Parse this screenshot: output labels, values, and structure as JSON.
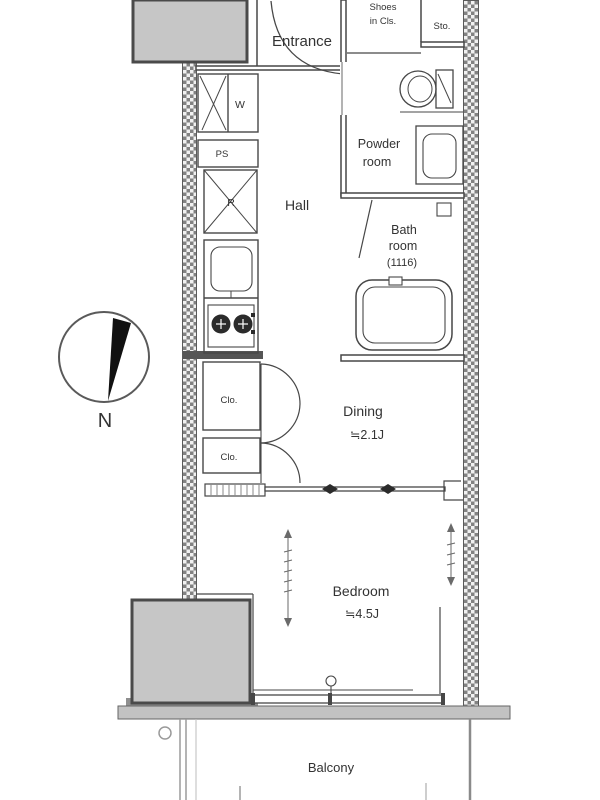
{
  "floor_plan": {
    "rooms": {
      "entrance": {
        "label": "Entrance"
      },
      "hall": {
        "label": "Hall"
      },
      "powder_room": {
        "label_line1": "Powder",
        "label_line2": "room"
      },
      "bath_room": {
        "label_line1": "Bath",
        "label_line2": "room",
        "size": "(1116)"
      },
      "dining": {
        "label": "Dining",
        "size": "≒2.1J"
      },
      "bedroom": {
        "label": "Bedroom",
        "size": "≒4.5J"
      },
      "balcony": {
        "label": "Balcony"
      }
    },
    "storage": {
      "shoes_closet": {
        "label_line1": "Shoes",
        "label_line2": "in Cls."
      },
      "storage_box": {
        "label": "Sto."
      },
      "washer": {
        "label": "W"
      },
      "pipe_space": {
        "label": "PS"
      },
      "refrigerator": {
        "label": "R"
      },
      "closet_upper": {
        "label": "Clo."
      },
      "closet_lower": {
        "label": "Clo."
      }
    },
    "compass": {
      "north_label": "N"
    },
    "colors": {
      "background": "#ffffff",
      "line": "#474747",
      "hatch_dark": "#828282",
      "block_fill": "#c6c6c6",
      "slab_fill": "#c2c2c2",
      "text": "#333333",
      "fixture_dark": "#2b2b2b"
    }
  }
}
